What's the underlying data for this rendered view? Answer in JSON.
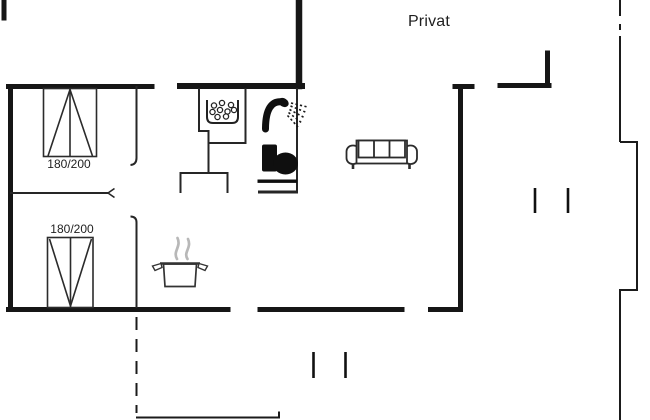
{
  "floorplan": {
    "privat_label": "Privat",
    "bedroom_top": {
      "bed_size_label": "180/200"
    },
    "bedroom_bottom": {
      "bed_size_label": "180/200"
    },
    "icons": [
      {
        "name": "double-bed-icon",
        "location": "bedroom-top"
      },
      {
        "name": "double-bed-icon",
        "location": "bedroom-bottom"
      },
      {
        "name": "washbasin-icon",
        "location": "bathroom"
      },
      {
        "name": "shower-icon",
        "location": "bathroom"
      },
      {
        "name": "toilet-icon",
        "location": "bathroom"
      },
      {
        "name": "cooking-pot-icon",
        "location": "kitchen"
      },
      {
        "name": "sofa-icon",
        "location": "living-room"
      }
    ],
    "colors": {
      "wall": "#161616",
      "interior_wall": "#262626",
      "steam": "#b8b8b8",
      "background": "#ffffff"
    }
  }
}
